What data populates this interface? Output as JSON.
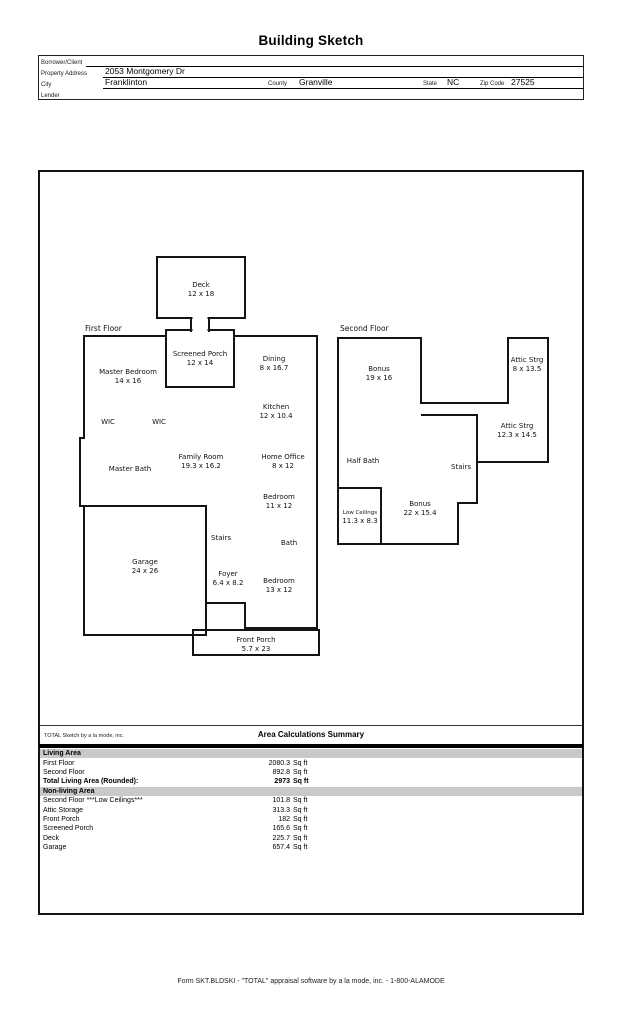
{
  "title": "Building Sketch",
  "header": {
    "borrower_label": "Borrower/Client",
    "borrower_value": "",
    "property_address_label": "Property Address",
    "property_address_value": "2053 Montgomery Dr",
    "city_label": "City",
    "city_value": "Franklinton",
    "county_label": "County",
    "county_value": "Granville",
    "state_label": "State",
    "state_value": "NC",
    "zip_label": "Zip Code",
    "zip_value": "27525",
    "lender_label": "Lender",
    "lender_value": ""
  },
  "sketch": {
    "first_floor_label": "First Floor",
    "second_floor_label": "Second Floor",
    "rooms_first": [
      {
        "name": "Deck",
        "dims": "12 x 18"
      },
      {
        "name": "Screened Porch",
        "dims": "12 x 14"
      },
      {
        "name": "Master Bedroom",
        "dims": "14 x 16"
      },
      {
        "name": "Dining",
        "dims": "8 x 16.7"
      },
      {
        "name": "Kitchen",
        "dims": "12 x 10.4"
      },
      {
        "name": "WIC",
        "dims": ""
      },
      {
        "name": "WIC",
        "dims": ""
      },
      {
        "name": "Family Room",
        "dims": "19.3 x 16.2"
      },
      {
        "name": "Home Office",
        "dims": "8 x 12"
      },
      {
        "name": "Master Bath",
        "dims": ""
      },
      {
        "name": "Bedroom",
        "dims": "11 x 12"
      },
      {
        "name": "Stairs",
        "dims": ""
      },
      {
        "name": "Bath",
        "dims": ""
      },
      {
        "name": "Garage",
        "dims": "24 x 26"
      },
      {
        "name": "Foyer",
        "dims": "6.4 x 8.2"
      },
      {
        "name": "Bedroom",
        "dims": "13 x 12"
      },
      {
        "name": "Front Porch",
        "dims": "5.7 x 23"
      }
    ],
    "rooms_second": [
      {
        "name": "Bonus",
        "dims": "19 x 16"
      },
      {
        "name": "Attic Strg",
        "dims": "8 x 13.5"
      },
      {
        "name": "Attic Strg",
        "dims": "12.3 x 14.5"
      },
      {
        "name": "Half Bath",
        "dims": ""
      },
      {
        "name": "Stairs",
        "dims": ""
      },
      {
        "name": "Bonus",
        "dims": "22 x 15.4"
      },
      {
        "name": "Low Ceilings",
        "dims": "11.3 x 8.3"
      }
    ]
  },
  "summary": {
    "sketch_by": "TOTAL Sketch by a la mode, inc.",
    "title": "Area Calculations Summary",
    "living_area_label": "Living Area",
    "living_rows": [
      {
        "label": "First Floor",
        "area": "2080.3",
        "unit": "Sq ft"
      },
      {
        "label": "Second Floor",
        "area": "892.8",
        "unit": "Sq ft"
      },
      {
        "label": "Total Living Area (Rounded):",
        "area": "2973",
        "unit": "Sq ft"
      }
    ],
    "nonliving_area_label": "Non-living Area",
    "nonliving_rows": [
      {
        "label": "Second Floor ***Low Ceilings***",
        "area": "101.8",
        "unit": "Sq ft"
      },
      {
        "label": "Attic Storage",
        "area": "313.3",
        "unit": "Sq ft"
      },
      {
        "label": "Front Porch",
        "area": "182",
        "unit": "Sq ft"
      },
      {
        "label": "Screened Porch",
        "area": "165.6",
        "unit": "Sq ft"
      },
      {
        "label": "Deck",
        "area": "225.7",
        "unit": "Sq ft"
      },
      {
        "label": "Garage",
        "area": "657.4",
        "unit": "Sq ft"
      }
    ]
  },
  "footer": "Form SKT.BLDSKI - \"TOTAL\" appraisal software by a la mode, inc. - 1-800-ALAMODE",
  "colors": {
    "band_gray": "#c9c9c9",
    "line_black": "#141414"
  }
}
